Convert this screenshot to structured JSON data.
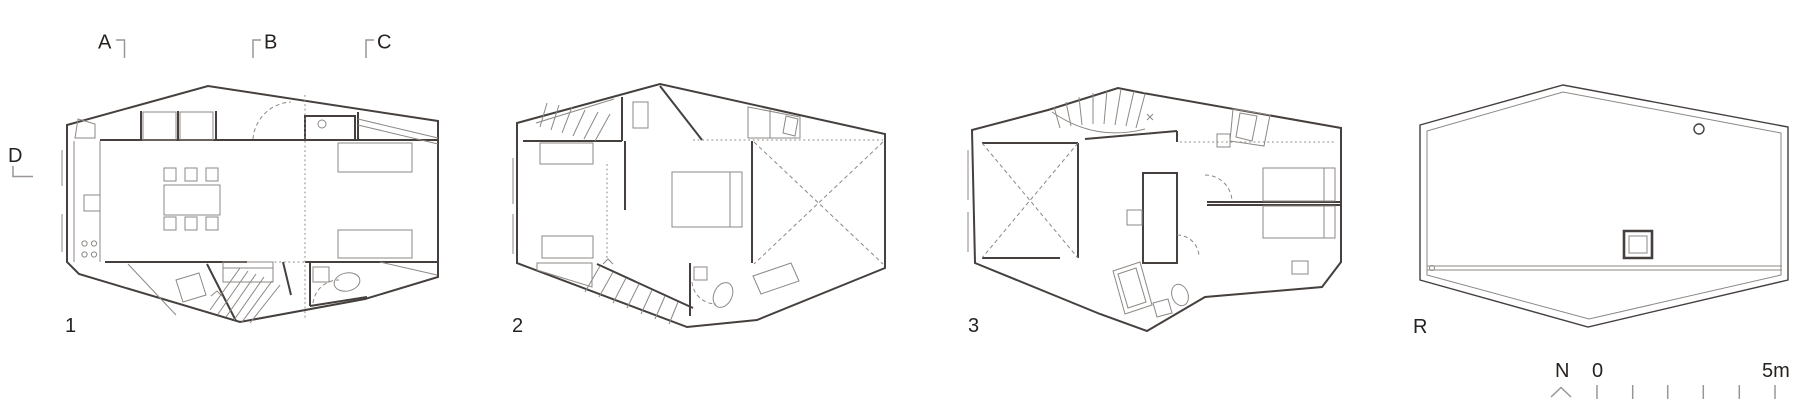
{
  "drawing": {
    "type": "architectural-floor-plans",
    "section_markers": {
      "a": "A",
      "b": "B",
      "c": "C",
      "d": "D"
    },
    "floors": {
      "level1": "1",
      "level2": "2",
      "level3": "3",
      "roof": "R"
    },
    "compass": {
      "north": "N"
    },
    "scale_bar": {
      "start": "0",
      "end": "5m"
    },
    "colors": {
      "wall_line": "#45403d",
      "thin_line": "#8d8884",
      "marker_line": "#9a9693",
      "text": "#272220",
      "background": "#ffffff"
    }
  }
}
